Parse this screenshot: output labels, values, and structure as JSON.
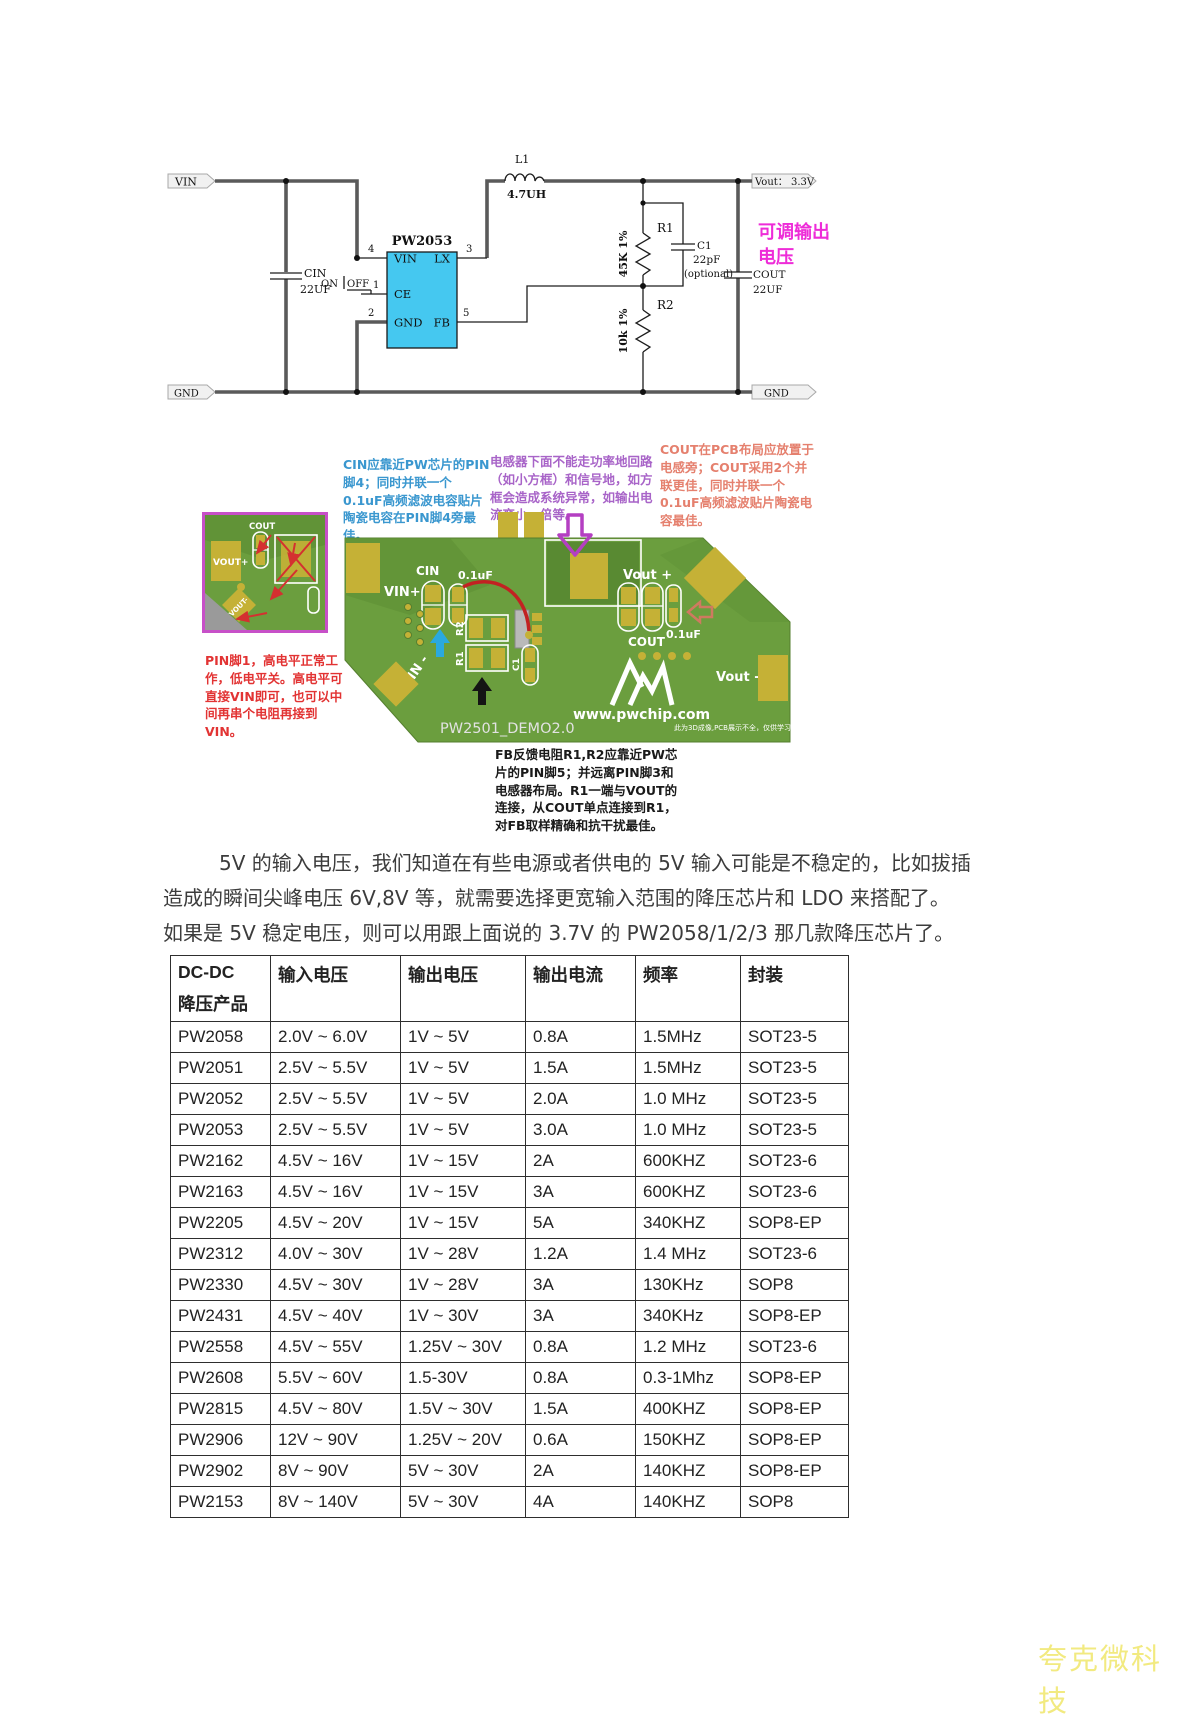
{
  "colors": {
    "magenta": "#ee2cd8",
    "chip-fill": "#45c8f0",
    "board-green": "#6b9e3e",
    "board-dark": "#5f9136",
    "pad-yellow": "#c5b136",
    "note-blue": "#3a97cf",
    "note-purple": "#a864c8",
    "note-salmon": "#e5806e",
    "note-red": "#e23333",
    "fb-black": "#1a1a1a",
    "watermark-yellow": "#f2ea80",
    "inset-border": "#c750c8"
  },
  "schematic": {
    "title": "PW2053",
    "flags": {
      "vin": "VIN",
      "vout": "Vout： 3.3V",
      "gnd_left": "GND",
      "gnd_right": "GND"
    },
    "pins": {
      "vin": "VIN",
      "ce": "CE",
      "gnd": "GND",
      "lx": "LX",
      "fb": "FB",
      "n1": "1",
      "n2": "2",
      "n3": "3",
      "n4": "4",
      "n5": "5"
    },
    "switch": {
      "on": "ON",
      "off": "OFF"
    },
    "components": {
      "cin_ref": "CIN",
      "cin_val": "22UF",
      "l1_ref": "L1",
      "l1_val": "4.7UH",
      "r1_ref": "R1",
      "r1_val": "45K 1%",
      "c1_ref": "C1",
      "c1_val": "22pF",
      "c1_note": "(optional)",
      "r2_ref": "R2",
      "r2_val": "10k 1%",
      "cout_ref": "COUT",
      "cout_val": "22UF"
    },
    "adjustable": {
      "line1": "可调输出",
      "line2": "电压"
    }
  },
  "pcb_figure": {
    "notes": {
      "cin": "CIN应靠近PW芯片的PIN脚4；同时并联一个0.1uF高频滤波电容贴片陶瓷电容在PIN脚4旁最佳。",
      "inductor": "电感器下面不能走功率地回路（如小方框）和信号地，如方框会造成系统异常，如输出电流变小一倍等。",
      "cout": "COUT在PCB布局应放置于电感旁；COUT采用2个并联更佳，同时并联一个0.1uF高频滤波贴片陶瓷电容最佳。",
      "pin1": "PIN脚1，高电平正常工作，低电平关。高电平可直接VIN即可，也可以中间再串个电阻再接到VIN。",
      "fb": "FB反馈电阻R1,R2应靠近PW芯片的PIN脚5；并远离PIN脚3和电感器布局。R1一端与VOUT的连接，从COUT单点连接到R1，对FB取样精确和抗干扰最佳。"
    },
    "board": {
      "name": "PW2501_DEMO2.0",
      "site": "www.pwchip.com",
      "disclaimer": "此为3D成像,PCB展示不全，仅供学习。",
      "labels": {
        "cin": "CIN",
        "cin_cap": "0.1uF",
        "vin_plus": "VIN+",
        "vin_minus": "VIN -",
        "r1": "R1",
        "r2": "R2",
        "c1": "C1",
        "vout_plus": "Vout +",
        "cout": "COUT",
        "cout_cap": "0.1uF",
        "vout_minus": "Vout -"
      }
    },
    "inset": {
      "cout": "COUT",
      "vout_plus": "VOUT+",
      "vout_minus": "VOUT-"
    }
  },
  "paragraph": {
    "line1": "5V 的输入电压，我们知道在有些电源或者供电的 5V 输入可能是不稳定的，比如拔插",
    "line2": "造成的瞬间尖峰电压 6V,8V 等，就需要选择更宽输入范围的降压芯片和 LDO 来搭配了。",
    "line3": "如果是 5V 稳定电压，则可以用跟上面说的 3.7V 的 PW2058/1/2/3 那几款降压芯片了。"
  },
  "table": {
    "headers": {
      "col0a": "DC-DC",
      "col0b": "降压产品",
      "col1": "输入电压",
      "col2": "输出电压",
      "col3": "输出电流",
      "col4": "频率",
      "col5": "封装"
    },
    "rows": [
      [
        "PW2058",
        "2.0V ~ 6.0V",
        "1V ~ 5V",
        "0.8A",
        "1.5MHz",
        "SOT23-5"
      ],
      [
        "PW2051",
        "2.5V ~ 5.5V",
        "1V ~ 5V",
        "1.5A",
        "1.5MHz",
        "SOT23-5"
      ],
      [
        "PW2052",
        "2.5V ~ 5.5V",
        "1V ~ 5V",
        "2.0A",
        "1.0 MHz",
        "SOT23-5"
      ],
      [
        "PW2053",
        "2.5V ~ 5.5V",
        "1V ~ 5V",
        "3.0A",
        "1.0 MHz",
        "SOT23-5"
      ],
      [
        "PW2162",
        "4.5V ~ 16V",
        "1V ~ 15V",
        "2A",
        "600KHZ",
        "SOT23-6"
      ],
      [
        "PW2163",
        "4.5V ~ 16V",
        "1V ~ 15V",
        "3A",
        "600KHZ",
        "SOT23-6"
      ],
      [
        "PW2205",
        "4.5V ~ 20V",
        "1V ~ 15V",
        "5A",
        "340KHZ",
        "SOP8-EP"
      ],
      [
        "PW2312",
        "4.0V ~ 30V",
        "1V ~ 28V",
        "1.2A",
        "1.4 MHz",
        "SOT23-6"
      ],
      [
        "PW2330",
        "4.5V ~ 30V",
        "1V ~ 28V",
        "3A",
        "130KHz",
        "SOP8"
      ],
      [
        "PW2431",
        "4.5V ~ 40V",
        "1V ~ 30V",
        "3A",
        "340KHz",
        "SOP8-EP"
      ],
      [
        "PW2558",
        "4.5V ~ 55V",
        "1.25V ~ 30V",
        "0.8A",
        "1.2 MHz",
        "SOT23-6"
      ],
      [
        "PW2608",
        "5.5V ~ 60V",
        "1.5-30V",
        "0.8A",
        "0.3-1Mhz",
        "SOP8-EP"
      ],
      [
        "PW2815",
        "4.5V ~ 80V",
        "1.5V ~ 30V",
        "1.5A",
        "400KHZ",
        "SOP8-EP"
      ],
      [
        "PW2906",
        "12V ~ 90V",
        "1.25V ~ 20V",
        "0.6A",
        "150KHZ",
        "SOP8-EP"
      ],
      [
        "PW2902",
        "8V ~ 90V",
        "5V ~ 30V",
        "2A",
        "140KHZ",
        "SOP8-EP"
      ],
      [
        "PW2153",
        "8V ~ 140V",
        "5V ~ 30V",
        "4A",
        "140KHZ",
        "SOP8"
      ]
    ]
  },
  "page": {
    "watermark": "夸克微科技"
  }
}
